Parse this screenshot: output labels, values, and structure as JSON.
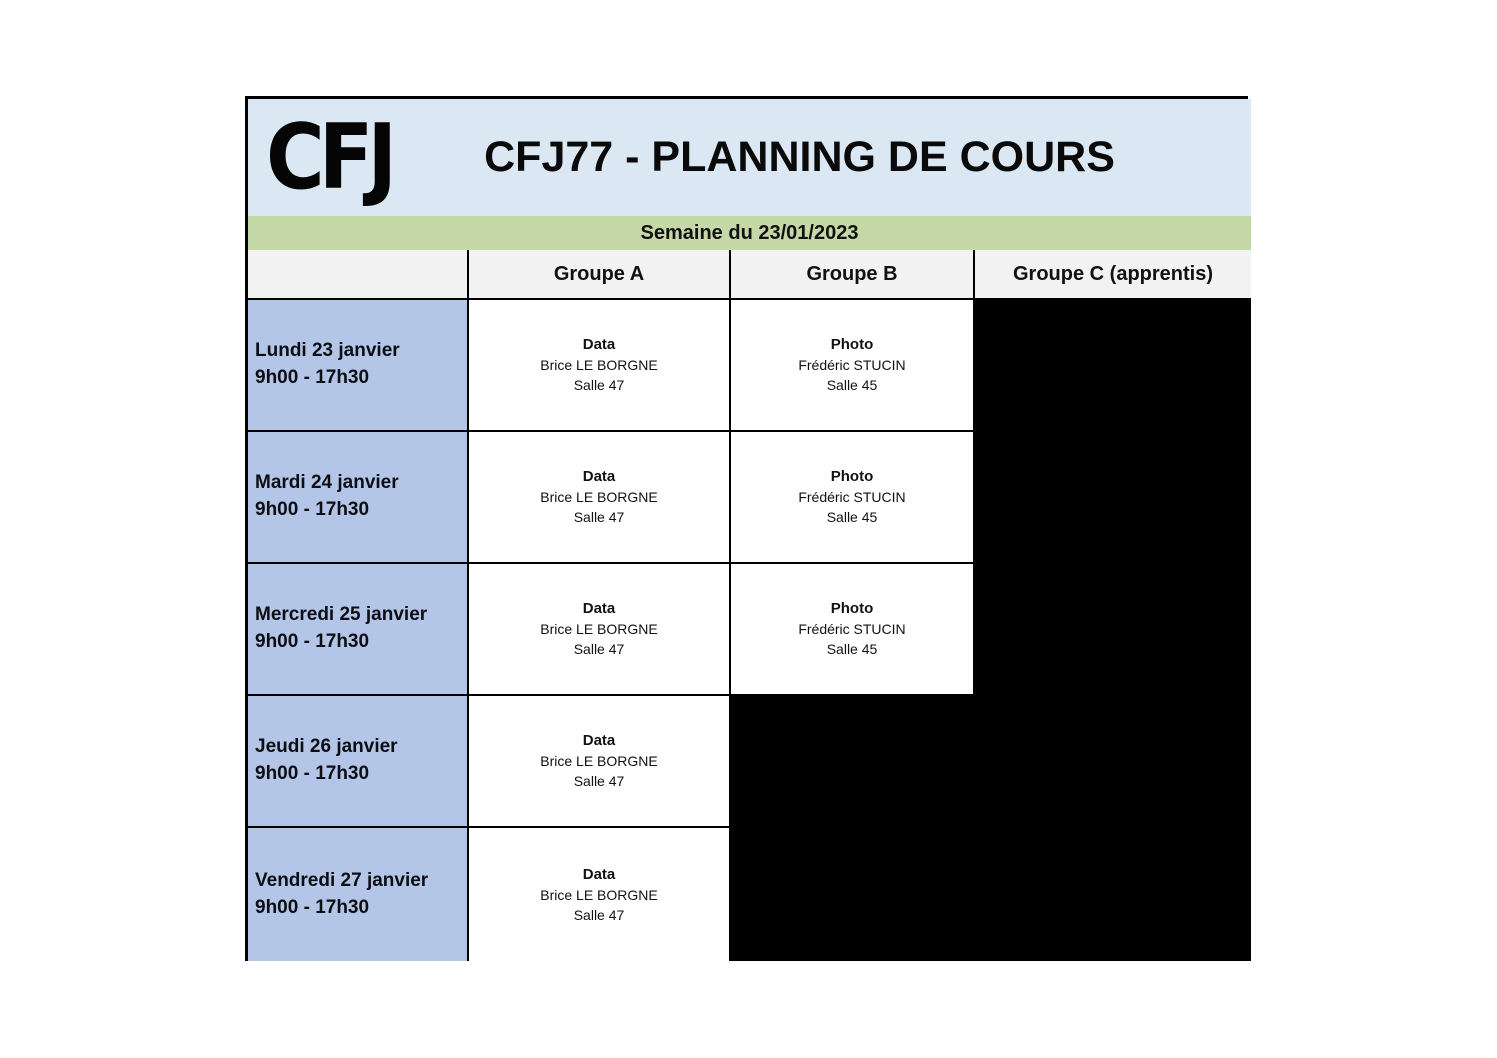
{
  "header": {
    "logo": "CFJ",
    "title": "CFJ77 - PLANNING DE COURS"
  },
  "week_banner": "Semaine du 23/01/2023",
  "columns": {
    "day": "",
    "group_a": "Groupe A",
    "group_b": "Groupe B",
    "group_c": "Groupe C (apprentis)"
  },
  "colors": {
    "title_bg": "#dbe8f4",
    "week_bg": "#c5d8a8",
    "header_bg": "#f2f2f2",
    "day_bg": "#b4c6e7",
    "blocked_bg": "#000000",
    "border_color": "#000000"
  },
  "schedule": {
    "rows": [
      {
        "day": "Lundi 23 janvier",
        "time": "9h00 - 17h30",
        "group_a": {
          "subject": "Data",
          "teacher": "Brice LE BORGNE",
          "room": "Salle 47"
        },
        "group_b": {
          "subject": "Photo",
          "teacher": "Frédéric STUCIN",
          "room": "Salle 45"
        },
        "group_c": null
      },
      {
        "day": "Mardi 24 janvier",
        "time": "9h00 - 17h30",
        "group_a": {
          "subject": "Data",
          "teacher": "Brice LE BORGNE",
          "room": "Salle 47"
        },
        "group_b": {
          "subject": "Photo",
          "teacher": "Frédéric STUCIN",
          "room": "Salle 45"
        },
        "group_c": null
      },
      {
        "day": "Mercredi 25 janvier",
        "time": "9h00 - 17h30",
        "group_a": {
          "subject": "Data",
          "teacher": "Brice LE BORGNE",
          "room": "Salle 47"
        },
        "group_b": {
          "subject": "Photo",
          "teacher": "Frédéric STUCIN",
          "room": "Salle 45"
        },
        "group_c": null
      },
      {
        "day": "Jeudi 26 janvier",
        "time": "9h00 - 17h30",
        "group_a": {
          "subject": "Data",
          "teacher": "Brice LE BORGNE",
          "room": "Salle 47"
        },
        "group_b": null,
        "group_c": null
      },
      {
        "day": "Vendredi 27 janvier",
        "time": "9h00 - 17h30",
        "group_a": {
          "subject": "Data",
          "teacher": "Brice LE BORGNE",
          "room": "Salle 47"
        },
        "group_b": null,
        "group_c": null
      }
    ]
  }
}
